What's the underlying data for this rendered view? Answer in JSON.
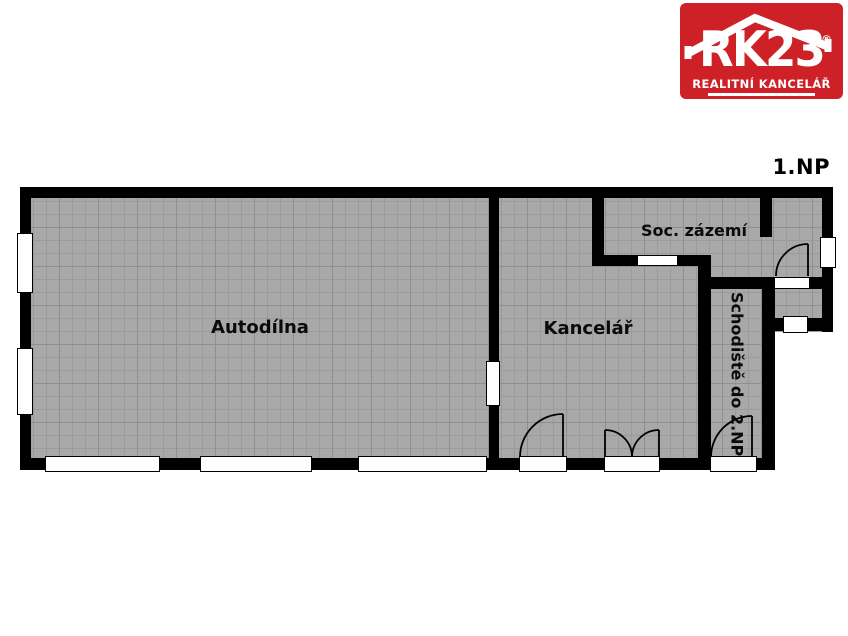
{
  "floor_label": "1.NP",
  "logo": {
    "brand": "RK23",
    "registered_mark": "®",
    "tagline": "REALITNÍ KANCELÁŘ"
  },
  "rooms": {
    "autodilna": {
      "label": "Autodílna"
    },
    "kancelar": {
      "label": "Kancelář"
    },
    "soc_zazemi": {
      "label": "Soc. zázemí"
    },
    "schodiste": {
      "label": "Schodiště do 2.NP"
    }
  },
  "colors": {
    "floor_grey": "#a8a8a8",
    "grid_fine": "#9b9b9b",
    "grid_bold": "#8f8f8f",
    "wall_black": "#000000",
    "logo_red": "#ce2127",
    "label_text": "#0a0a0a"
  }
}
